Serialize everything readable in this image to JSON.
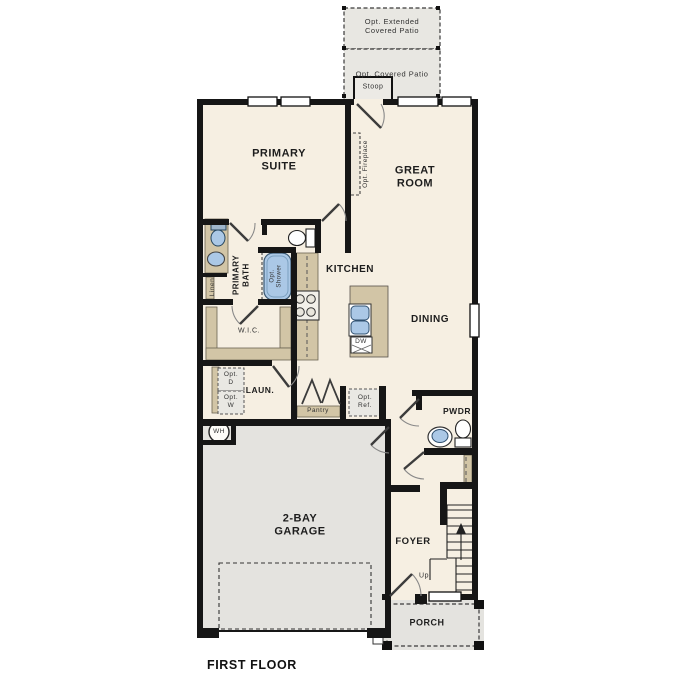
{
  "title": "FIRST FLOOR",
  "rooms": {
    "primary_suite": "PRIMARY\nSUITE",
    "great_room": "GREAT\nROOM",
    "kitchen": "KITCHEN",
    "dining": "DINING",
    "primary_bath": "PRIMARY\nBATH",
    "wic": "W.I.C.",
    "laundry": "LAUN.",
    "pantry": "Pantry",
    "linen": "Linen",
    "garage": "2-BAY\nGARAGE",
    "pwdr": "PWDR",
    "foyer": "FOYER",
    "porch": "PORCH",
    "stoop": "Stoop"
  },
  "optional_items": {
    "extended_patio": "Opt. Extended\nCovered Patio",
    "covered_patio": "Opt. Covered Patio",
    "fireplace": "Opt. Fireplace",
    "shower": "Opt.\nShower",
    "dryer": "Opt.\nD",
    "washer": "Opt.\nW",
    "fridge": "Opt.\nRef."
  },
  "labels": {
    "up": "Up",
    "dishwasher": "DW",
    "water_heater": "WH"
  },
  "colors": {
    "wall": "#161616",
    "interior_floor": "#f6efe2",
    "garage_floor": "#e4e3df",
    "patio_fill": "#e8e7e2",
    "counter_tan": "#d2c5a6",
    "fixture_blue": "#abc8e6",
    "dash_line": "#444444",
    "text": "#1d1d1d"
  }
}
